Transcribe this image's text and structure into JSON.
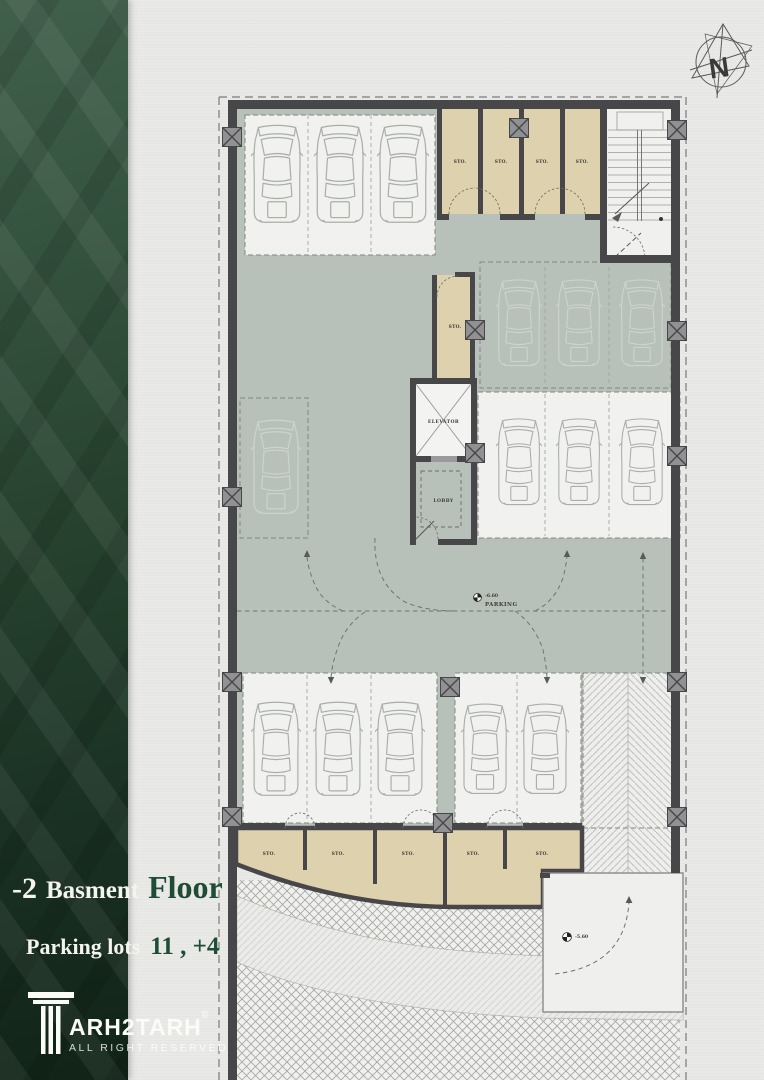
{
  "page": {
    "background": "#e9e9e7"
  },
  "sidebar": {
    "title": {
      "number": "-2",
      "word": "Basment",
      "word2": "Floor"
    },
    "stats": {
      "label": "Parking lots",
      "value": "11 , +4"
    },
    "logo": {
      "brand": "ARH2TARH",
      "copyright": "©",
      "tagline": "ALL RIGHT RESERVED"
    },
    "colors": {
      "panel_green": "#27432f",
      "accent_green": "#1e4c34",
      "text_on_green": "#f4f4ef"
    }
  },
  "compass": {
    "label": "N"
  },
  "plan": {
    "labels": {
      "storage": "STO.",
      "elevator": "ELEVATOR",
      "lobby": "LOBBY",
      "parking": "PARKING",
      "level_parking": "-6.60",
      "level_ramp": "-5.60"
    },
    "colors": {
      "wall": "#47474a",
      "floor": "#b7c1ba",
      "storage_fill": "#ddd1ae",
      "bay_fill": "#f1f1ef"
    }
  }
}
